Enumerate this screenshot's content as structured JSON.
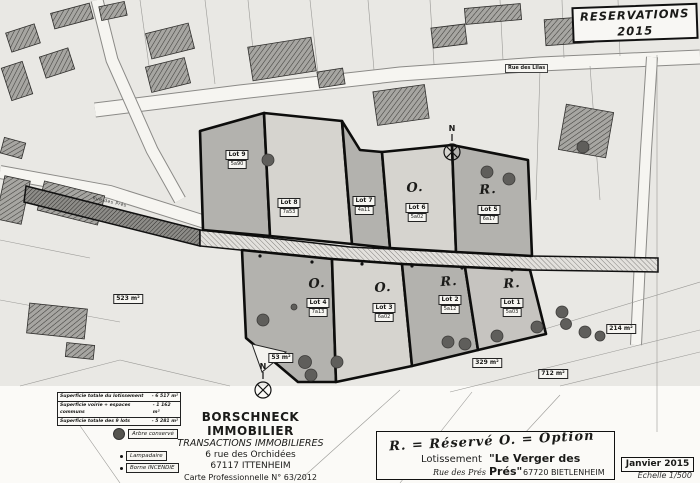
{
  "header": {
    "reservations_title": "RESERVATIONS 2015"
  },
  "streets": {
    "rue_des_lilas": "Rue des Lilas",
    "rue_des_pres": "Rue des Prés"
  },
  "compass": {
    "north": "N"
  },
  "summary": {
    "rows": [
      {
        "label": "Superficie totale du lotissement",
        "value": "- 6 517 m²"
      },
      {
        "label": "Superficie voirie + espaces communs",
        "value": "- 1 162 m²"
      },
      {
        "label": "Superficie totale des 9 lots",
        "value": "- 5 281 m²"
      }
    ]
  },
  "legend": {
    "arbre": "Arbre conservé",
    "lampadaire": "Lampadaire",
    "borne": "Borne INCENDIE"
  },
  "company": {
    "name": "BORSCHNECK IMMOBILIER",
    "type": "TRANSACTIONS IMMOBILIERES",
    "address": "6 rue des Orchidées",
    "city": "67117 ITTENHEIM",
    "carte": "Carte Professionnelle N° 63/2012"
  },
  "title_block": {
    "note": "R. = Réservé   O. = Option",
    "lotissement": "Lotissement",
    "name": "\"Le Verger des Prés\"",
    "street": "Rue des Prés",
    "city": "67720 BIETLENHEIM"
  },
  "date_block": {
    "date": "Janvier 2015",
    "scale": "Echelle 1/500"
  },
  "area_labels": {
    "a523": "523 m²",
    "a53": "53 m²",
    "a329": "329 m²",
    "a712": "712 m²",
    "a214": "214 m²"
  },
  "lots": [
    {
      "id": "lot9",
      "label": "Lot 9",
      "area": "5a90",
      "mark": ""
    },
    {
      "id": "lot8",
      "label": "Lot 8",
      "area": "7a53",
      "mark": ""
    },
    {
      "id": "lot7",
      "label": "Lot 7",
      "area": "4a11",
      "mark": ""
    },
    {
      "id": "lot6",
      "label": "Lot 6",
      "area": "5a02",
      "mark": "O."
    },
    {
      "id": "lot5",
      "label": "Lot 5",
      "area": "6a17",
      "mark": "R."
    },
    {
      "id": "lot4",
      "label": "Lot 4",
      "area": "7a13",
      "mark": "O."
    },
    {
      "id": "lot3",
      "label": "Lot 3",
      "area": "6a02",
      "mark": "O."
    },
    {
      "id": "lot2",
      "label": "Lot 2",
      "area": "5a12",
      "mark": "R."
    },
    {
      "id": "lot1",
      "label": "Lot 1",
      "area": "5a03",
      "mark": "R."
    }
  ],
  "colors": {
    "lot_dark": "#b3b2ae",
    "lot_light": "#d6d4cf",
    "tree": "#5f5e5b",
    "paper": "#fbfaf7"
  }
}
